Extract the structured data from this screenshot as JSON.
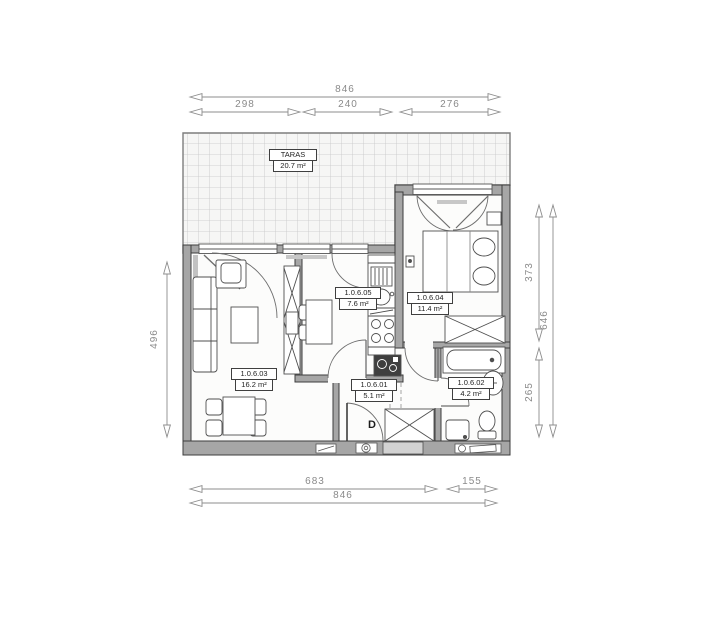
{
  "plan": {
    "terrace": {
      "label": "TARAS",
      "area": "20.7 m²"
    },
    "rooms": {
      "living": {
        "id": "1.0.6.03",
        "area": "16.2 m²"
      },
      "kitchen": {
        "id": "1.0.6.05",
        "area": "7.6 m²"
      },
      "bedroom": {
        "id": "1.0.6.04",
        "area": "11.4 m²"
      },
      "hall": {
        "id": "1.0.6.01",
        "area": "5.1 m²"
      },
      "bathroom": {
        "id": "1.0.6.02",
        "area": "4.2 m²"
      }
    },
    "entrance_door_label": "D",
    "dimensions": {
      "top": {
        "total": "846",
        "segments": [
          "298",
          "240",
          "276"
        ]
      },
      "bottom": {
        "total": "846",
        "segments": [
          "683",
          "155"
        ]
      },
      "left": {
        "total": "496"
      },
      "right": {
        "total": "646",
        "segments": [
          "373",
          "265"
        ]
      }
    },
    "colors": {
      "wall": "#a6a6a6",
      "wall_outline": "#3d3d3d",
      "floor": "#fcfcfb",
      "terrace_fill": "#f6f6f5",
      "terrace_grid": "#c6c6c6",
      "dimension": "#8c8c8c",
      "furniture": "#4f4f4f"
    }
  }
}
